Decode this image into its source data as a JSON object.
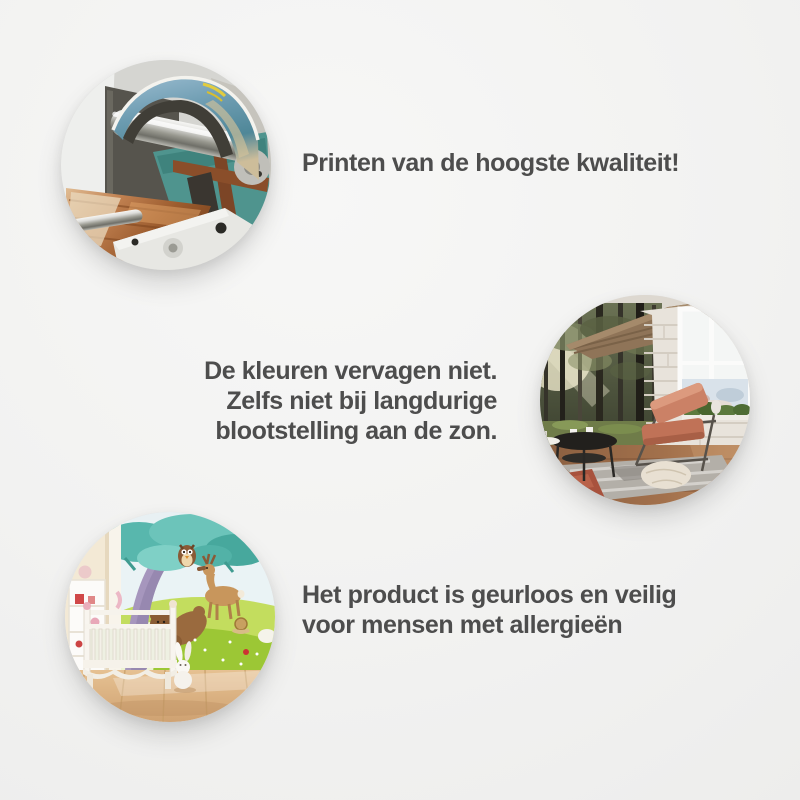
{
  "page": {
    "background_color": "#f2f2f1",
    "text_color": "#4d4d4d"
  },
  "features": [
    {
      "id": "print-quality",
      "photo_alt": "Close-up of a large-format printer with a metal roller printing a colorful seascape photo over a wooden pier image",
      "lines": [
        "Printen van de hoogste kwaliteit!"
      ]
    },
    {
      "id": "fade-resistant",
      "photo_alt": "Living room with a sunlit forest photo wall mural, white brick wall, large window and a salmon leather armchair",
      "lines": [
        "De kleuren vervagen niet.",
        "Zelfs niet bij langdurige",
        "blootstelling aan de zon."
      ]
    },
    {
      "id": "odorless-allergy-safe",
      "photo_alt": "Nursery with a cartoon wall mural of a tree, owl, deer and bears behind a white crib and a plush bunny",
      "lines": [
        "Het product is geurloos en veilig",
        "voor mensen met allergieën"
      ]
    }
  ]
}
